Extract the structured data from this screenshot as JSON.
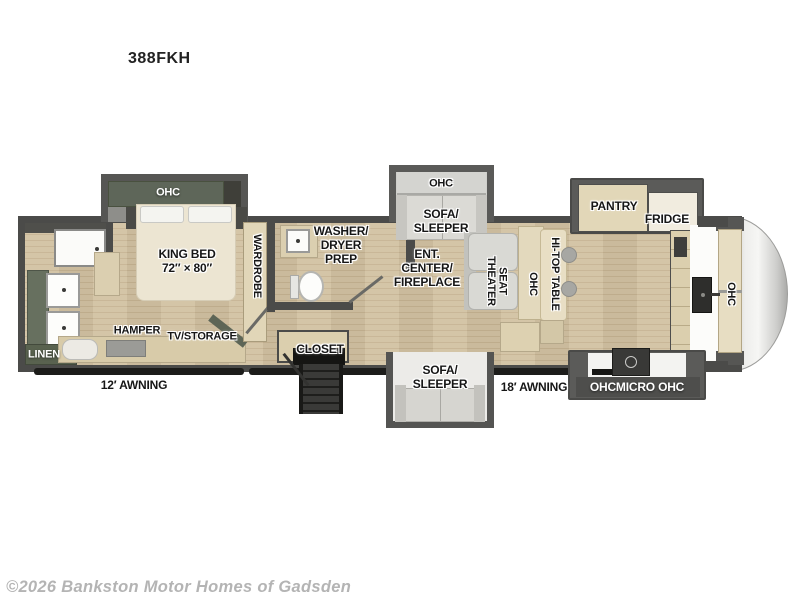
{
  "title": "388FKH",
  "watermark": "©2026 Bankston Motor Homes of Gadsden",
  "colors": {
    "wall_gray": "#4b4b49",
    "slide_gray": "#5a5a58",
    "floor_tan": "#cfc0a0",
    "cabinet_tan": "#ddd2b4",
    "cabinet_green": "#5e6659",
    "bed_cream": "#ece5d2",
    "sofa_gray": "#d8d7d2",
    "front_cap_silver": "#d9d9d7",
    "awning_black": "#1c1c1a",
    "label_black": "#161616",
    "label_white": "#ffffff",
    "watermark_gray": "#b4b4b4"
  },
  "bedroom": {
    "ohc_label": "OHC",
    "bed_line1": "KING BED",
    "bed_line2": "72″ × 80″",
    "wardrobe_label": "WARDROBE",
    "hamper_label": "HAMPER",
    "tv_storage_label": "TV/STORAGE"
  },
  "rear_bath": {
    "linen_label": "LINEN"
  },
  "mid_bath": {
    "washer_line1": "WASHER/",
    "washer_line2": "DRYER",
    "washer_line3": "PREP",
    "closet_label": "CLOSET"
  },
  "living": {
    "ohc_top_label": "OHC",
    "sofa_top_line1": "SOFA/",
    "sofa_top_line2": "SLEEPER",
    "ent_line1": "ENT.",
    "ent_line2": "CENTER/",
    "ent_line3": "FIREPLACE",
    "theater_line1": "THEATER",
    "theater_line2": "SEAT",
    "ohc_mid_label": "OHC",
    "hitop_label": "HI-TOP TABLE",
    "sofa_bottom_line1": "SOFA/",
    "sofa_bottom_line2": "SLEEPER"
  },
  "kitchen": {
    "pantry_label": "PANTRY",
    "fridge_label": "FRIDGE",
    "ohc_micro_label": "OHCMICRO OHC"
  },
  "front": {
    "ohc_label": "OHC"
  },
  "exterior": {
    "awning_left": "12′ AWNING",
    "awning_right": "18′ AWNING"
  }
}
